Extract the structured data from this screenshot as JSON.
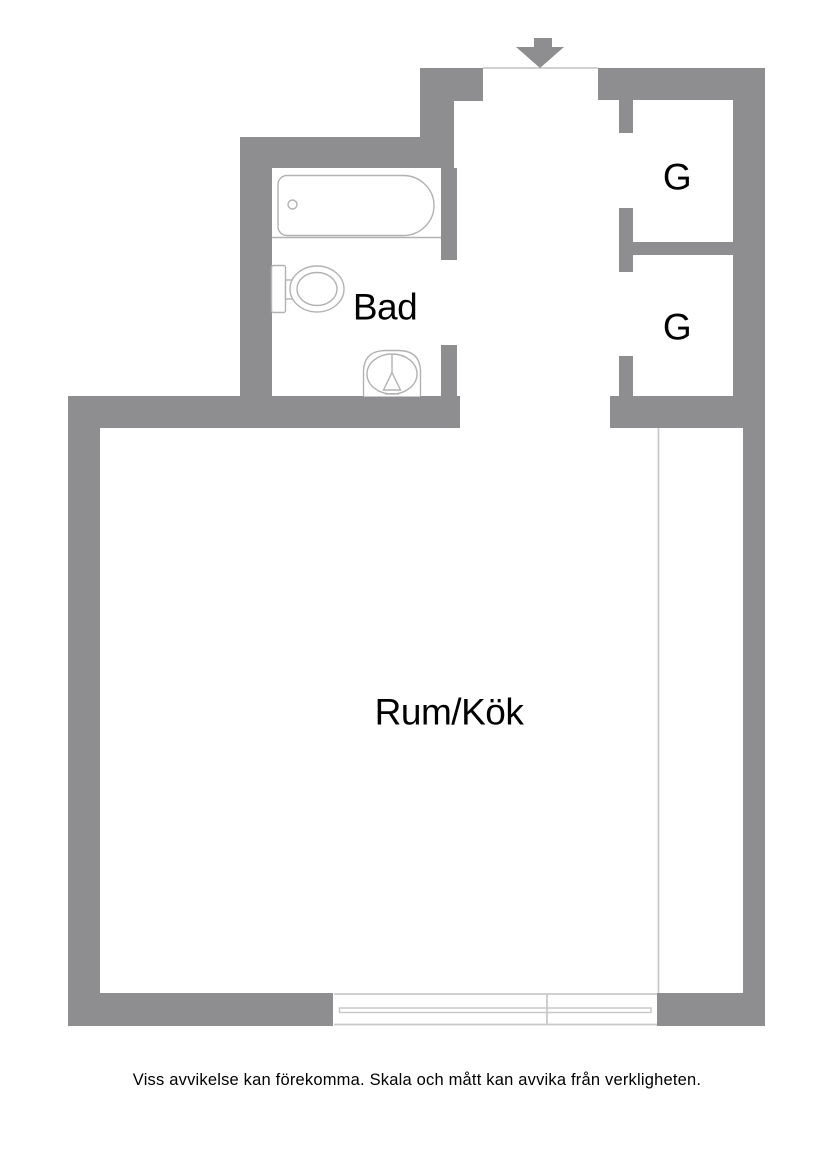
{
  "rooms": {
    "bathroom": "Bad",
    "main": "Rum/Kök",
    "closet_top": "G",
    "closet_bottom": "G"
  },
  "disclaimer": "Viss avvikelse kan förekomma. Skala och mått kan avvika från verkligheten.",
  "colors": {
    "wall": "#8e8e90",
    "thin_line": "#c8c9ca",
    "fixture_line": "#b2b2b2",
    "text": "#000000",
    "background": "#ffffff"
  },
  "icons": {
    "entrance_arrow": "entrance-direction-arrow-down",
    "bathtub": "bathtub",
    "toilet": "toilet",
    "sink": "washbasin",
    "window": "window"
  }
}
